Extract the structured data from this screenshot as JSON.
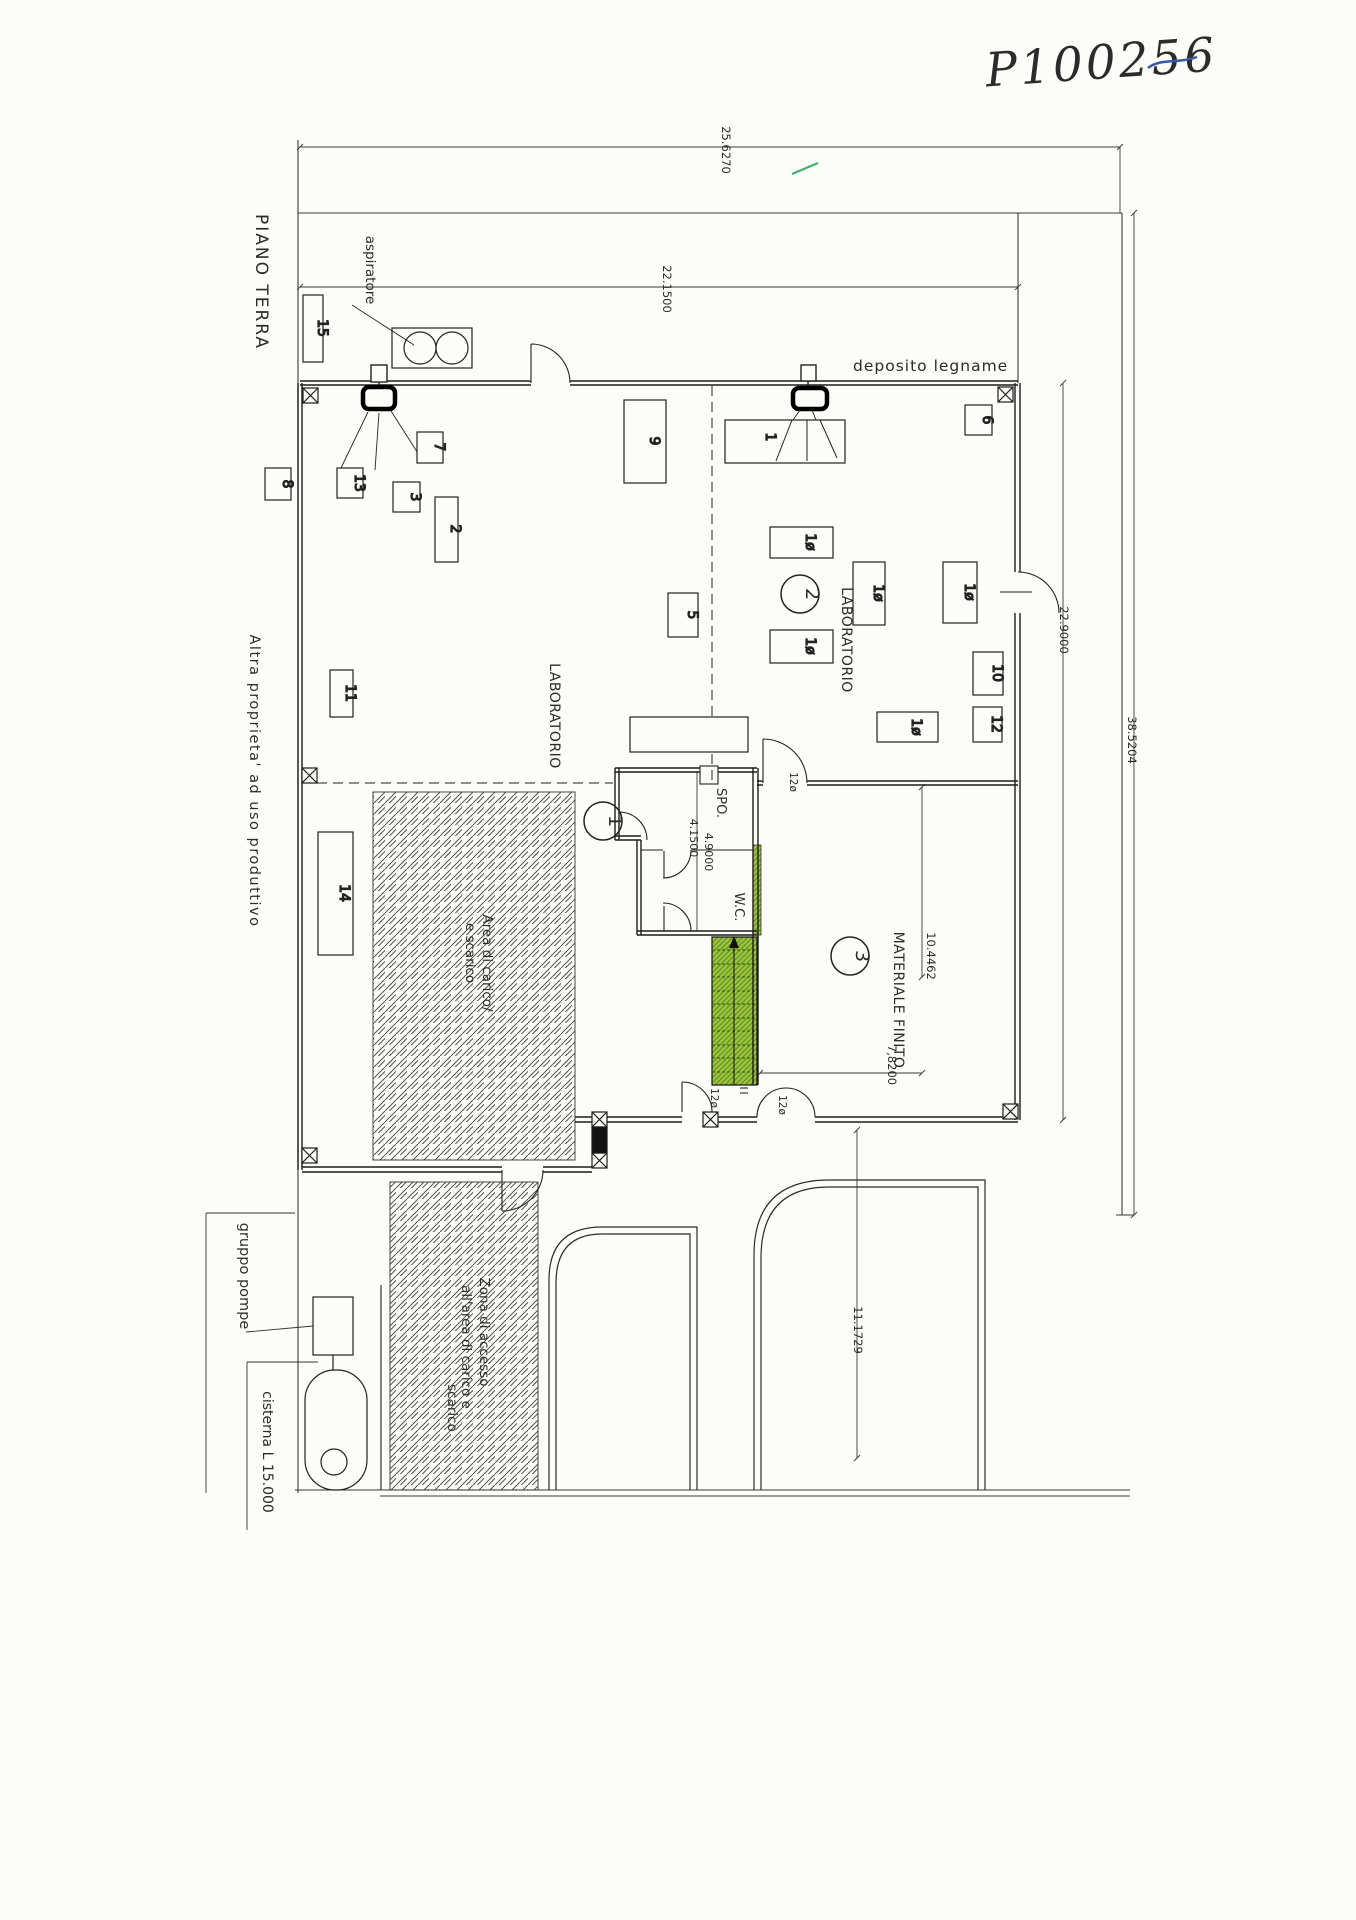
{
  "titles": {
    "piano": "PIANO TERRA",
    "code": "P100256",
    "altra": "Altra proprieta' ad uso produttivo"
  },
  "rooms": {
    "lab": "LABORATORIO",
    "materiale": "MATERIALE FINITO",
    "spo": "SPO.",
    "wc": "W.C.",
    "deposito": "deposito legname"
  },
  "zones": {
    "carico1": "Area di carico/",
    "carico2": "e scarico",
    "zona1": "Zona di accesso",
    "zona2": "all'area di carico e",
    "zona3": "scarico",
    "pompe": "gruppo pompe",
    "cisterna": "cisterna L 15.000",
    "aspiratore": "aspiratore"
  },
  "dims": {
    "w_outer": "25.6270",
    "w_building": "22.1500",
    "h_building": "22.9000",
    "h_outer": "38.5204",
    "h_room": "10.4462",
    "w_room": "7,8200",
    "spo_h": "4.9000",
    "spo_w": "4.1500",
    "yard": "11.1729"
  },
  "doors": {
    "d120": "12ø"
  },
  "machines": {
    "m1": "1",
    "m2": "2",
    "m3": "3",
    "m5": "5",
    "m6": "6",
    "m7": "7",
    "m8": "8",
    "m9": "9",
    "m10": "10",
    "m11": "11",
    "m12": "12",
    "m13": "13",
    "m14": "14",
    "m15": "15",
    "m10s": "1ø"
  },
  "plan_refs": {
    "r1": "1",
    "r2": "2",
    "r3": "3"
  },
  "colors": {
    "stair_green": "#9cc43f",
    "hatch_green": "#5d8a1e",
    "ink_blue": "#3757a8",
    "line": "#2b2b2b",
    "paper": "#fcfcf9",
    "mark_green": "#3fae6a"
  }
}
